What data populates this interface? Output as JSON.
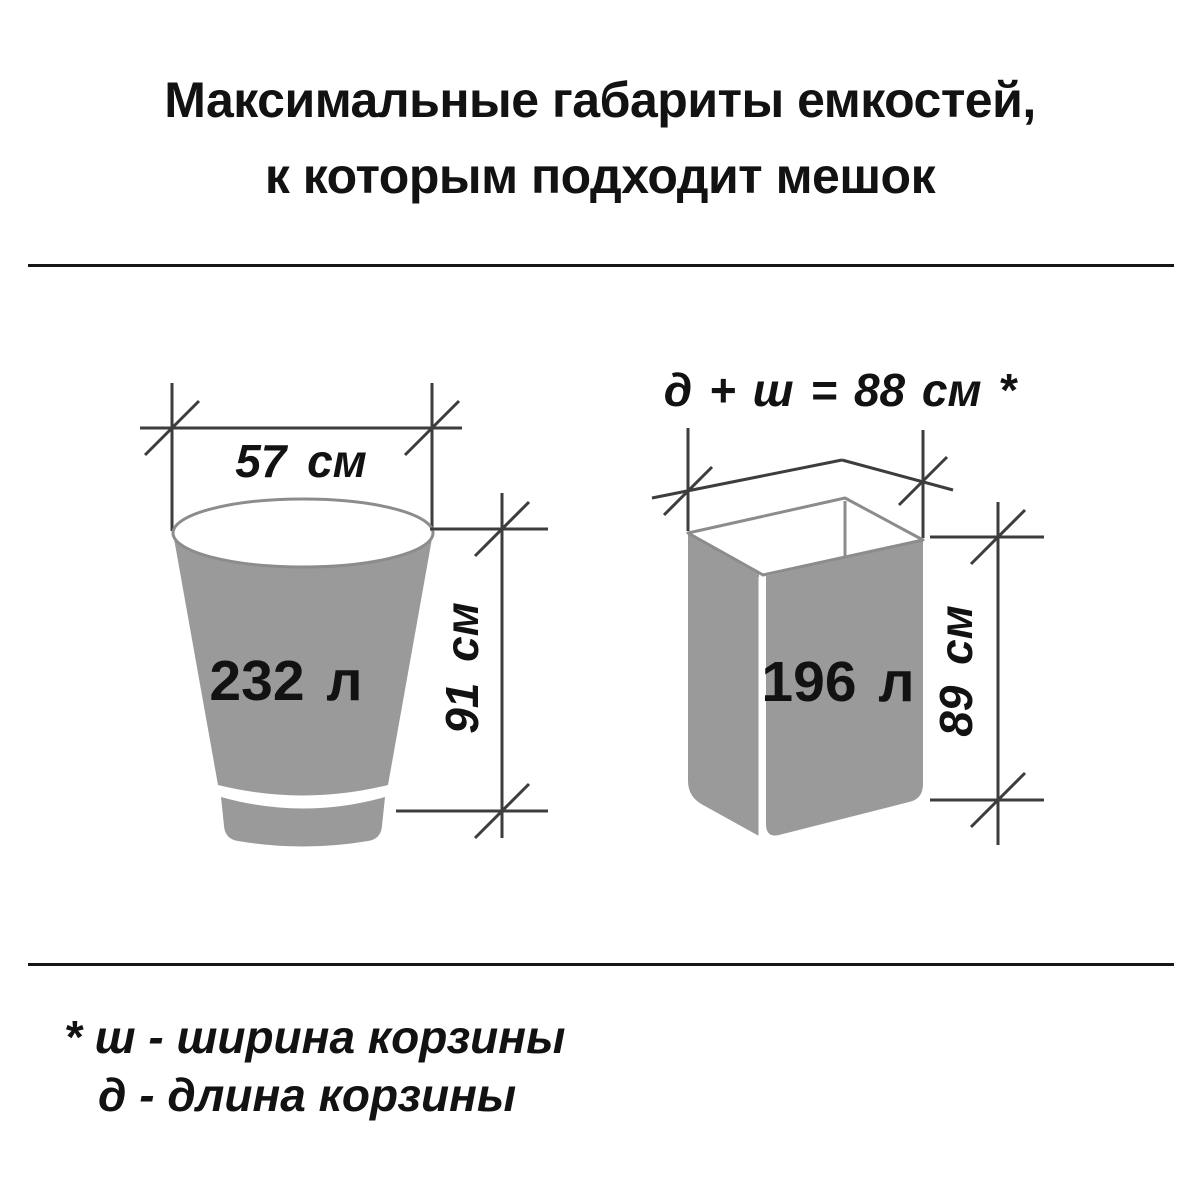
{
  "title": {
    "line1": "Максимальные габариты емкостей,",
    "line2": "к которым подходит мешок"
  },
  "figures": {
    "bucket": {
      "width_label": "57 см",
      "height_label": "91 см",
      "volume_label": "232 л"
    },
    "basket": {
      "dimension_formula": "д + ш = 88 см *",
      "height_label": "89 см",
      "volume_label": "196 л"
    }
  },
  "footnote": {
    "line1": "* ш - ширина корзины",
    "line2": "д - длина корзины"
  },
  "colors": {
    "container_fill": "#9a9a9a",
    "container_outline": "#8c8c8c",
    "dimension_line": "#3d3d3d",
    "text": "#121212"
  }
}
